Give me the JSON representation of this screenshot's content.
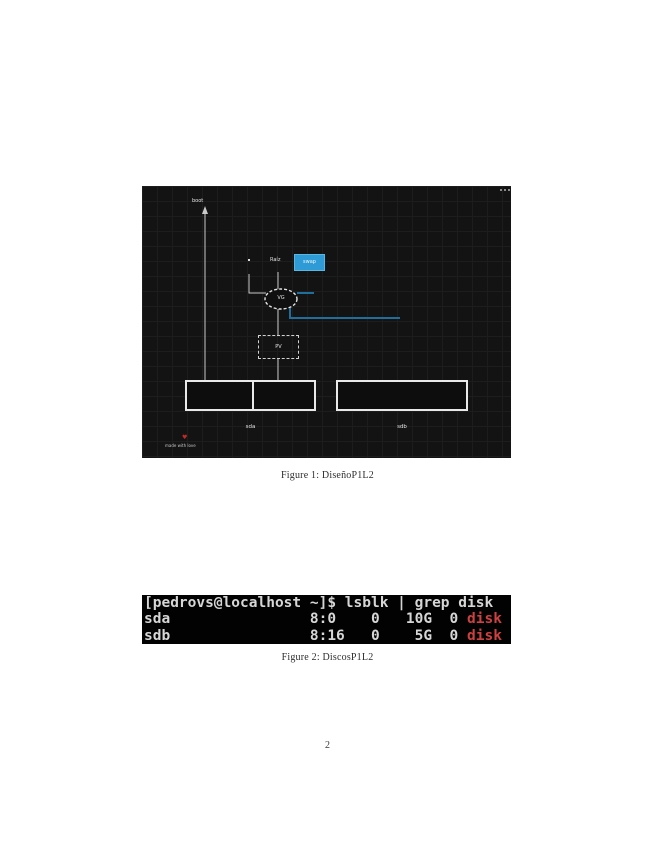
{
  "colors": {
    "accent-blue": "#2e9bd6",
    "accent-blue-border": "#58b7e3",
    "connector-blue": "#1f6e9c",
    "terminal-fg": "#d6d6d6",
    "terminal-red": "#cf4040"
  },
  "page": {
    "number": "2"
  },
  "figure1": {
    "caption": "Figure 1: DiseñoP1L2",
    "diagram": {
      "boot_label": "boot",
      "lv_name_label": "Raíz",
      "lv_box_label": "swap",
      "vg_label": "VG",
      "pv_label": "PV",
      "disk_left_label": "sda",
      "disk_right_label": "sdb",
      "watermark_symbol": "♥",
      "watermark_text": "made with love"
    }
  },
  "figure2": {
    "caption": "Figure 2: DiscosP1L2",
    "terminal": {
      "prompt_line": "[pedrovs@localhost ~]$ lsblk | grep disk",
      "rows": [
        {
          "pre": "sda                8:0    0   10G  0 ",
          "highlight": "disk"
        },
        {
          "pre": "sdb                8:16   0    5G  0 ",
          "highlight": "disk"
        }
      ]
    }
  }
}
